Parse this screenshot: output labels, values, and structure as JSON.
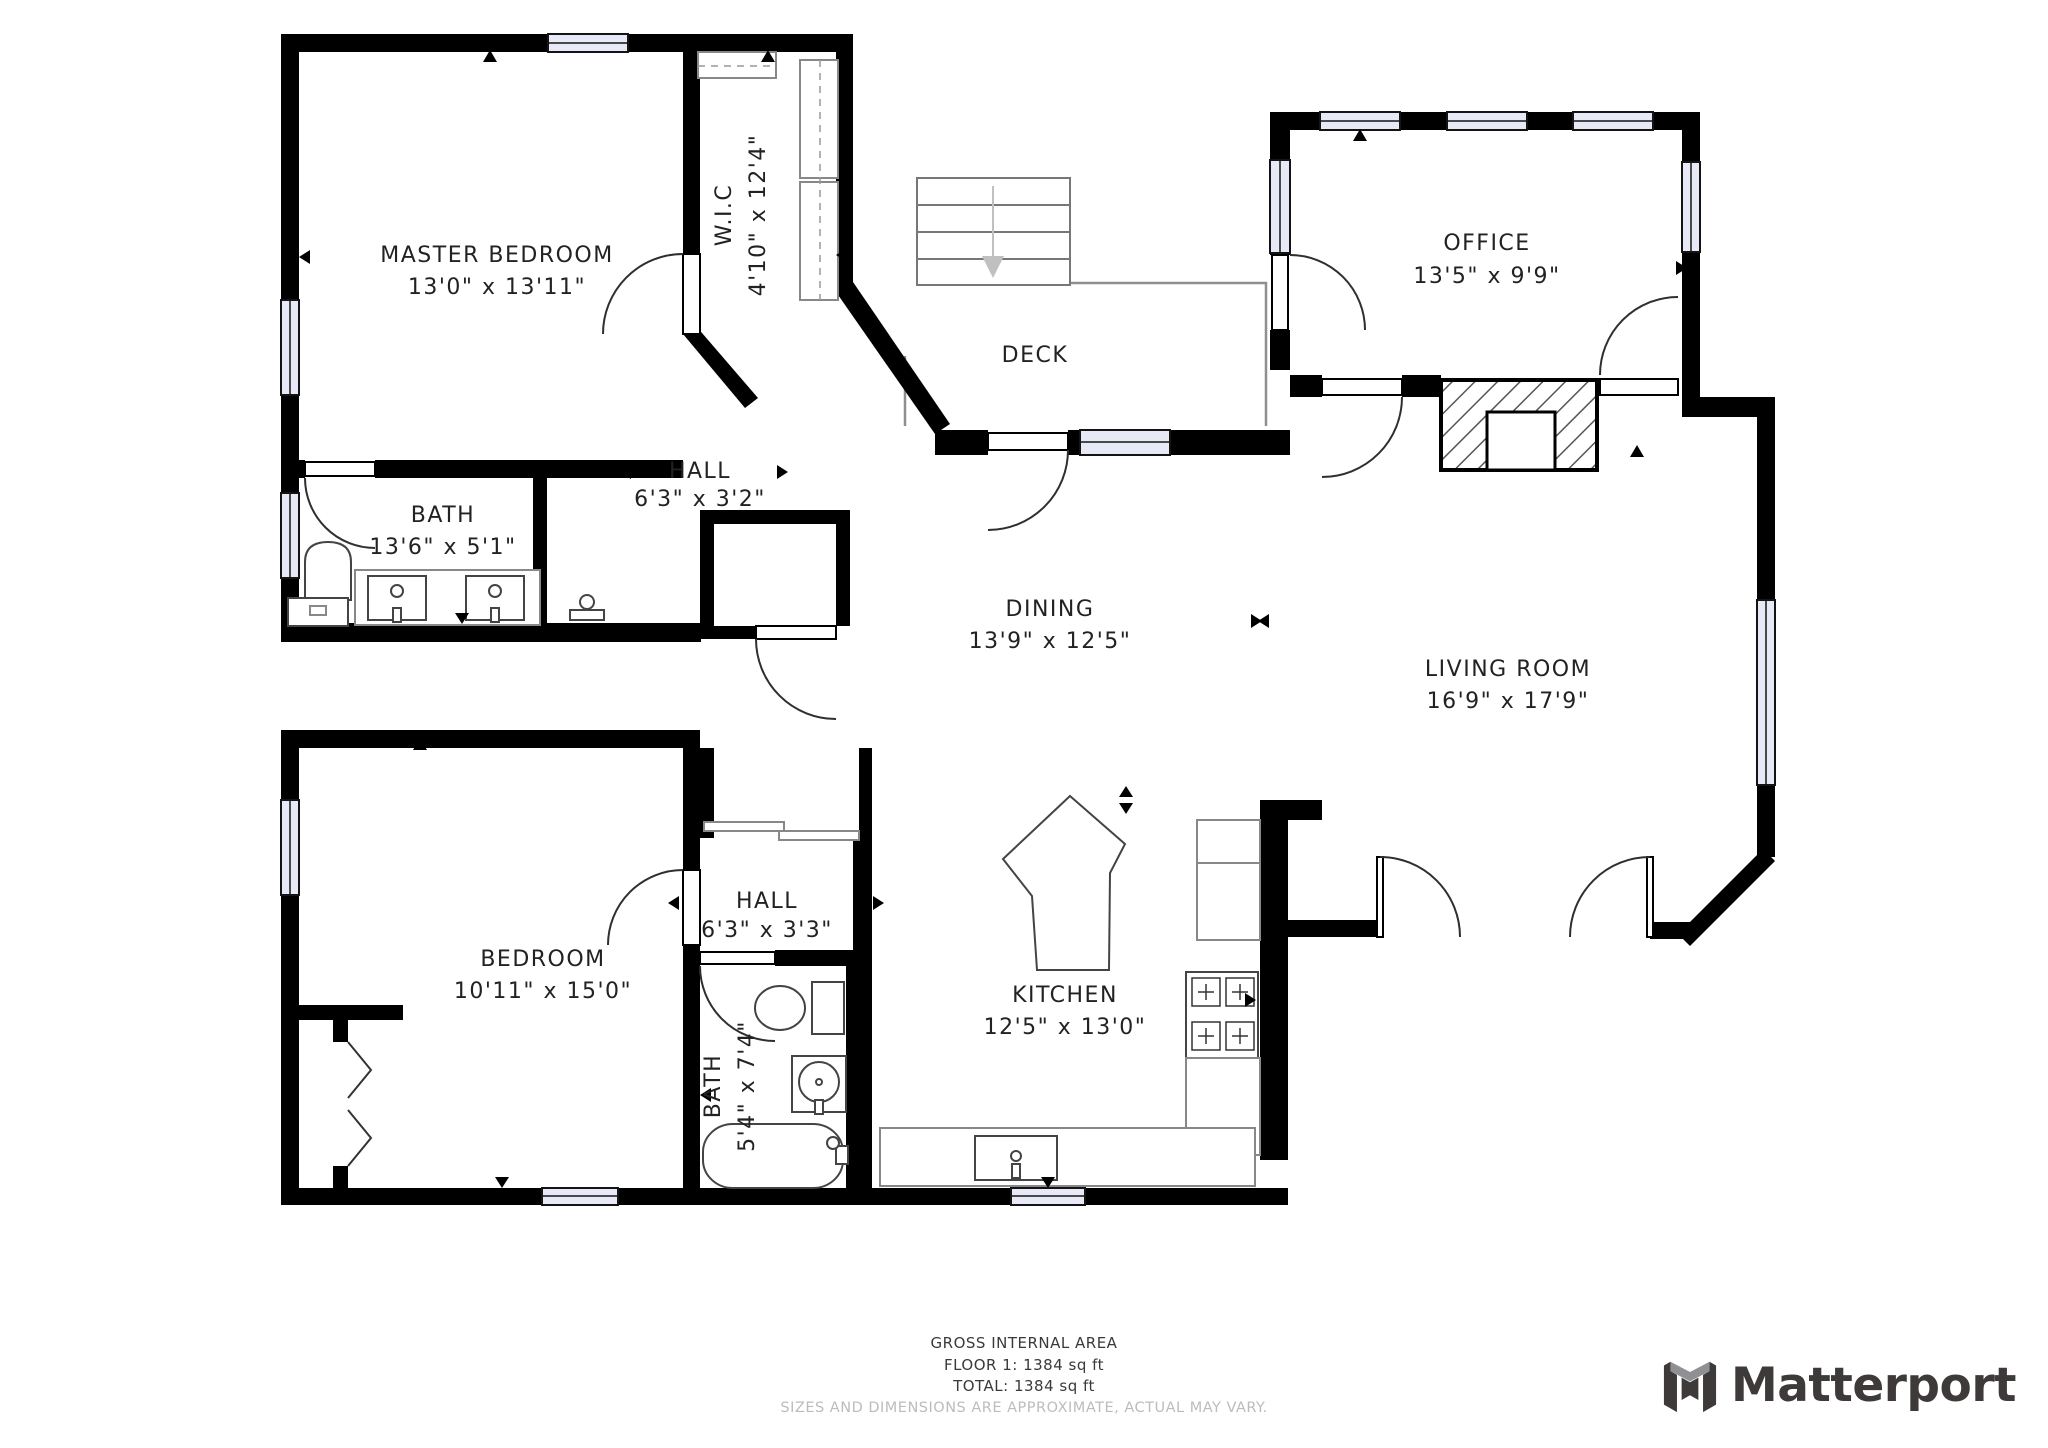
{
  "plan": {
    "rooms": [
      {
        "id": "master-bedroom",
        "name": "MASTER BEDROOM",
        "dims": "13'0\" x 13'11\""
      },
      {
        "id": "wic",
        "name": "W.I.C",
        "dims": "4'10\" x 12'4\""
      },
      {
        "id": "deck",
        "name": "DECK",
        "dims": ""
      },
      {
        "id": "office",
        "name": "OFFICE",
        "dims": "13'5\" x 9'9\""
      },
      {
        "id": "bath-master",
        "name": "BATH",
        "dims": "13'6\" x 5'1\""
      },
      {
        "id": "hall-upper",
        "name": "HALL",
        "dims": "6'3\" x 3'2\""
      },
      {
        "id": "dining",
        "name": "DINING",
        "dims": "13'9\" x 12'5\""
      },
      {
        "id": "living-room",
        "name": "LIVING ROOM",
        "dims": "16'9\" x 17'9\""
      },
      {
        "id": "bedroom",
        "name": "BEDROOM",
        "dims": "10'11\" x 15'0\""
      },
      {
        "id": "hall-lower",
        "name": "HALL",
        "dims": "6'3\" x 3'3\""
      },
      {
        "id": "bath-lower",
        "name": "BATH",
        "dims": "5'4\" x 7'4\""
      },
      {
        "id": "kitchen",
        "name": "KITCHEN",
        "dims": "12'5\" x 13'0\""
      }
    ]
  },
  "footer": {
    "line1": "GROSS INTERNAL AREA",
    "line2": "FLOOR 1: 1384 sq ft",
    "line3": "TOTAL: 1384 sq ft",
    "disclaimer": "SIZES AND DIMENSIONS ARE APPROXIMATE, ACTUAL MAY VARY."
  },
  "branding": {
    "name": "Matterport"
  },
  "colors": {
    "wall": "#000000",
    "window_fill": "#e8e9f6",
    "deck_line": "#8f8f8f",
    "label_text": "#222222",
    "footer_text": "#3a3a3a",
    "disclaimer_text": "#bcbcbc",
    "logo_dark": "#3e3a39",
    "logo_gray": "#8f8f94"
  }
}
